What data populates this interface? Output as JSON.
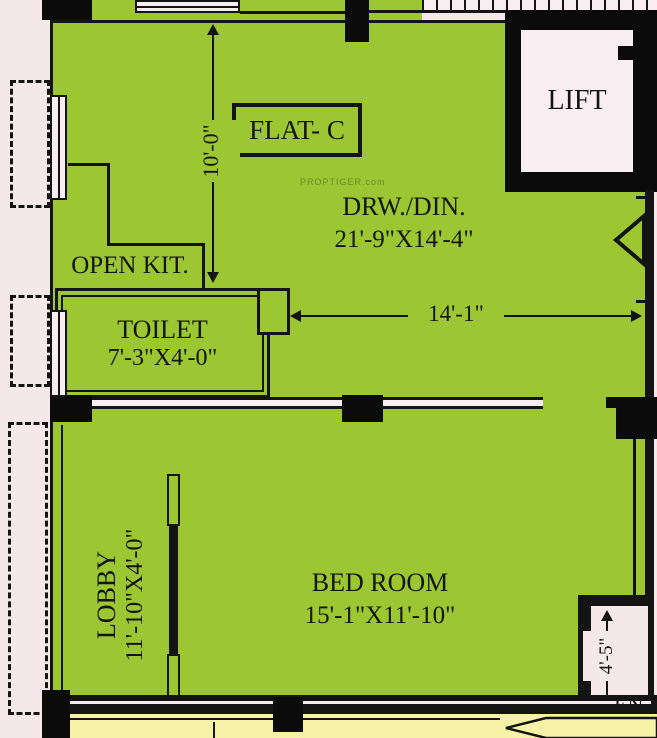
{
  "plan": {
    "flat_label": "FLAT- C",
    "watermark": "PROPTIGER.com",
    "entry_label": "EN",
    "rooms": {
      "lift": {
        "name": "LIFT"
      },
      "drawing_dining": {
        "name": "DRW./DIN.",
        "size": "21'-9\"X14'-4\""
      },
      "open_kitchen": {
        "name": "OPEN KIT."
      },
      "toilet": {
        "name": "TOILET",
        "size": "7'-3\"X4'-0\""
      },
      "bed_room": {
        "name": "BED ROOM",
        "size": "15'-1\"X11'-10\""
      },
      "lobby": {
        "name": "LOBBY",
        "size": "11'-10\"X4'-0\""
      }
    },
    "dimensions": {
      "drw_height": "10'-0\"",
      "drw_width": "14'-1\"",
      "entry_width": "4'-5\""
    },
    "colors": {
      "floor_green": "#9cc732",
      "background_pink": "#f5e8eb",
      "corridor_yellow": "#f6f3a7",
      "room_white": "#f8edf0",
      "line_dark": "#141414"
    }
  }
}
